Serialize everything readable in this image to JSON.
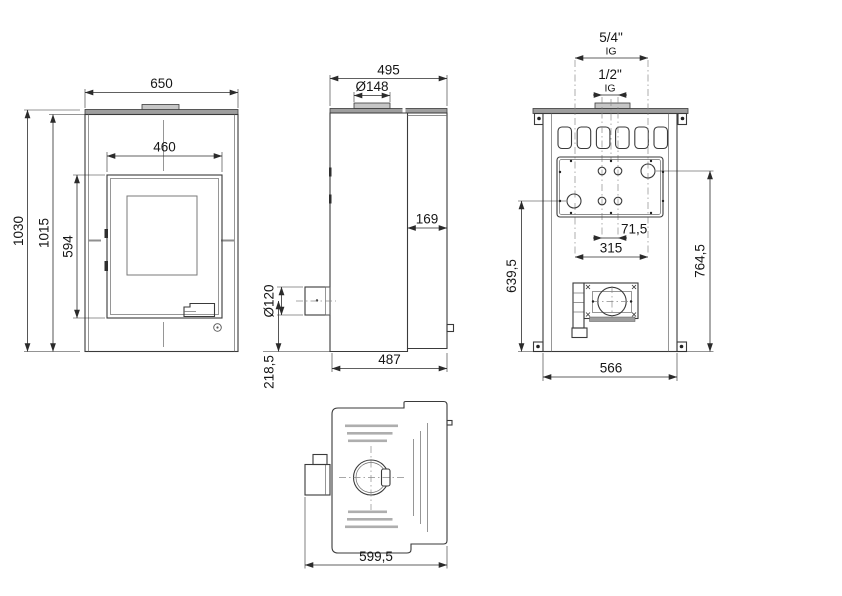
{
  "drawing": {
    "kind": "technical dimension drawing, water-heating stove (front / side / back / top views)",
    "dims": {
      "front_width": "650",
      "front_total_height": "1030",
      "front_body_height": "1015",
      "door_width": "460",
      "door_height": "594",
      "depth": "495",
      "top_flue_diameter": "Ø148",
      "front_section_depth": "169",
      "rear_flue_diameter": "Ø120",
      "rear_flue_height": "218,5",
      "base_depth": "487",
      "large_conn_size": "5/4\"",
      "large_conn_thread": "IG",
      "small_conn_size": "1/2\"",
      "small_conn_thread": "IG",
      "small_conn_spacing": "71,5",
      "large_conn_spacing": "315",
      "lower_conn_height": "639,5",
      "upper_conn_height": "764,5",
      "back_width": "566",
      "total_depth_with_outlet": "599,5"
    },
    "colors": {
      "line": "#3a3a3a",
      "dimension": "#2b2b2b",
      "plate_fill": "#9e9e9e",
      "slot_fill": "#aeaeae",
      "background": "#ffffff"
    }
  }
}
